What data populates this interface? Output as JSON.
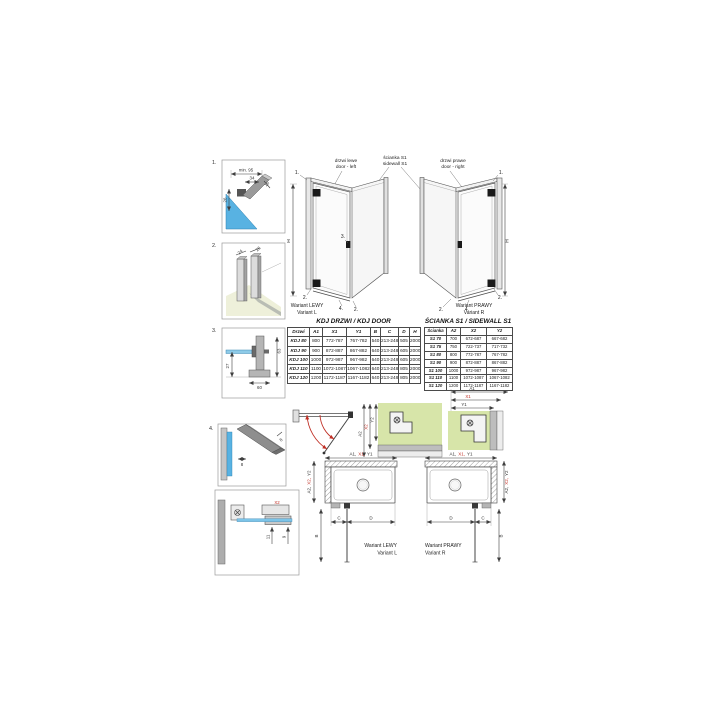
{
  "colors": {
    "accent_red": "#c03026",
    "glass_blue": "#58b2e2",
    "highlight_green": "#d7e5a9",
    "profile_grey": "#9a9a9a",
    "line_dark": "#3f3f3f"
  },
  "callout_numbers": {
    "n1": "1.",
    "n2": "2.",
    "n3": "3.",
    "n4": "4."
  },
  "detail_1": {
    "dim_min": "min. 95",
    "dim_34": "34",
    "dim_16": "16",
    "dim_26": "26"
  },
  "detail_2": {
    "dim_24": "24",
    "dim_26": "26"
  },
  "detail_3": {
    "dim_63": "63",
    "dim_27": "27",
    "dim_60": "60"
  },
  "detail_4": {
    "dim_w8": "8",
    "dim_h8": "8"
  },
  "detail_5": {
    "dim_x2": "X2",
    "dim_11": "11",
    "dim_9": "9"
  },
  "iso_views": {
    "door_left_pl": "drzwi lewe",
    "door_left_en": "door - left",
    "sidewall_pl": "ścianka S1",
    "sidewall_en": "sidewall S1",
    "door_right_pl": "drzwi prawe",
    "door_right_en": "door - right",
    "height_dim": "H",
    "variant_left_pl": "Wariant LEWY",
    "variant_left_en": "Variant L",
    "variant_right_pl": "Wariant PRAWY",
    "variant_right_en": "Variant R"
  },
  "door_table": {
    "title": "KDJ DRZWI / KDJ DOOR",
    "headers": [
      "Drzwi",
      "A1",
      "X1",
      "Y1",
      "B",
      "C",
      "D",
      "H"
    ],
    "red_index": 2,
    "col_widths": [
      22,
      13,
      24,
      24,
      10,
      18,
      11,
      11
    ],
    "rows": [
      [
        "KDJ 80",
        "800",
        "772-787",
        "767-782",
        "540",
        "213-248",
        "505",
        "2000"
      ],
      [
        "KDJ 90",
        "900",
        "872-887",
        "867-882",
        "640",
        "213-248",
        "605",
        "2000"
      ],
      [
        "KDJ 100",
        "1000",
        "972-987",
        "967-982",
        "640",
        "213-248",
        "605",
        "2000"
      ],
      [
        "KDJ 110",
        "1100",
        "1072-1087",
        "1067-1082",
        "640",
        "213-248",
        "805",
        "2000"
      ],
      [
        "KDJ 120",
        "1200",
        "1172-1187",
        "1167-1182",
        "640",
        "213-248",
        "805",
        "2000"
      ]
    ]
  },
  "sidewall_table": {
    "title": "ŚCIANKA S1 / SIDEWALL S1",
    "headers": [
      "Ścianka",
      "A2",
      "X2",
      "Y2"
    ],
    "red_index": 2,
    "col_widths": [
      22,
      14,
      26,
      26
    ],
    "rows": [
      [
        "S1 70",
        "700",
        "672-687",
        "667-682"
      ],
      [
        "S1 75",
        "750",
        "722-737",
        "717-732"
      ],
      [
        "S1 80",
        "800",
        "772-787",
        "767-782"
      ],
      [
        "S1 90",
        "900",
        "872-887",
        "867-882"
      ],
      [
        "S1 100",
        "1000",
        "972-987",
        "967-982"
      ],
      [
        "S1 110",
        "1100",
        "1072-1087",
        "1067-1082"
      ],
      [
        "S1 120",
        "1200",
        "1172-1187",
        "1167-1182"
      ]
    ]
  },
  "corner_details": {
    "a1": "A1",
    "x1": "X1",
    "y1": "Y1",
    "a2": "A2",
    "x2": "X2",
    "y2": "Y2"
  },
  "plans": {
    "top": [
      "A1,",
      "X1,",
      "Y1"
    ],
    "side": [
      "A2,",
      "X2,",
      "Y2"
    ],
    "dim_b": "B",
    "dim_c": "C",
    "dim_d": "D",
    "variant_left_pl": "Wariant LEWY",
    "variant_left_en": "Variant L",
    "variant_right_pl": "Wariant PRAWY",
    "variant_right_en": "Variant R"
  }
}
